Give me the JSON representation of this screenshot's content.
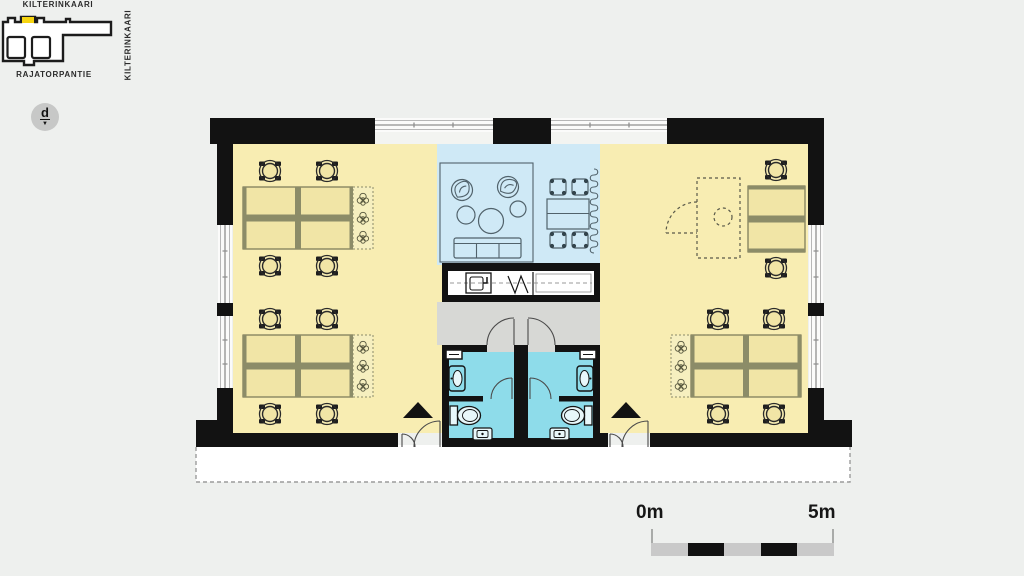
{
  "site_map": {
    "street_top": "KILTERINKAARI",
    "street_right": "KILTERINKAARI",
    "street_bottom": "RAJATORPANTIE",
    "highlight_color": "#f6d410"
  },
  "floor_selector": {
    "label": "d",
    "arrow": "▼"
  },
  "scale_bar": {
    "start": "0m",
    "end": "5m"
  },
  "palette": {
    "background": "#eef0ee",
    "wall": "#121212",
    "office_floor": "#f8edb2",
    "lounge_floor": "#cfe9f6",
    "wet_room_floor": "#8edcea",
    "corridor_floor": "#d7d8d5",
    "terrace": "#ffffff",
    "desk_fill": "#f1e5a6",
    "desk_divider": "#8c8c68",
    "scale_bar_gray": "#c9c9c9",
    "minimap_circle": "#c7c8c7",
    "highlight": "#f6d410"
  }
}
